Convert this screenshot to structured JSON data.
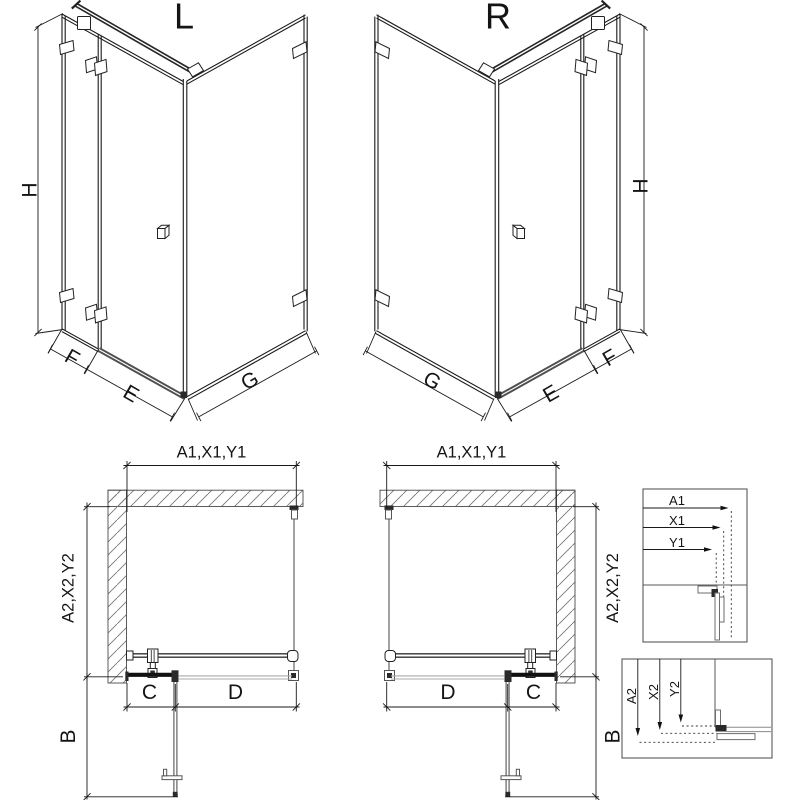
{
  "drawing": {
    "iso_left": {
      "label": "L",
      "dim_height": "H",
      "dim_panel": "F",
      "dim_door": "E",
      "dim_return": "G"
    },
    "iso_right": {
      "label": "R",
      "dim_height": "H",
      "dim_panel": "F",
      "dim_door": "E",
      "dim_return": "G"
    },
    "plan_left": {
      "dim_width": "A1,X1,Y1",
      "dim_depth": "A2,X2,Y2",
      "dim_c": "C",
      "dim_d": "D",
      "dim_b": "B"
    },
    "plan_right": {
      "dim_width": "A1,X1,Y1",
      "dim_depth": "A2,X2,Y2",
      "dim_c": "C",
      "dim_d": "D",
      "dim_b": "B"
    },
    "detail_width": {
      "rows": [
        "A1",
        "X1",
        "Y1"
      ]
    },
    "detail_depth": {
      "rows": [
        "A2",
        "X2",
        "Y2"
      ]
    },
    "colors": {
      "line": "#1a1a1a",
      "glass": "#8a8a8a",
      "wall": "#4a4a4a",
      "hatch": "#777777",
      "bg": "#ffffff"
    }
  }
}
